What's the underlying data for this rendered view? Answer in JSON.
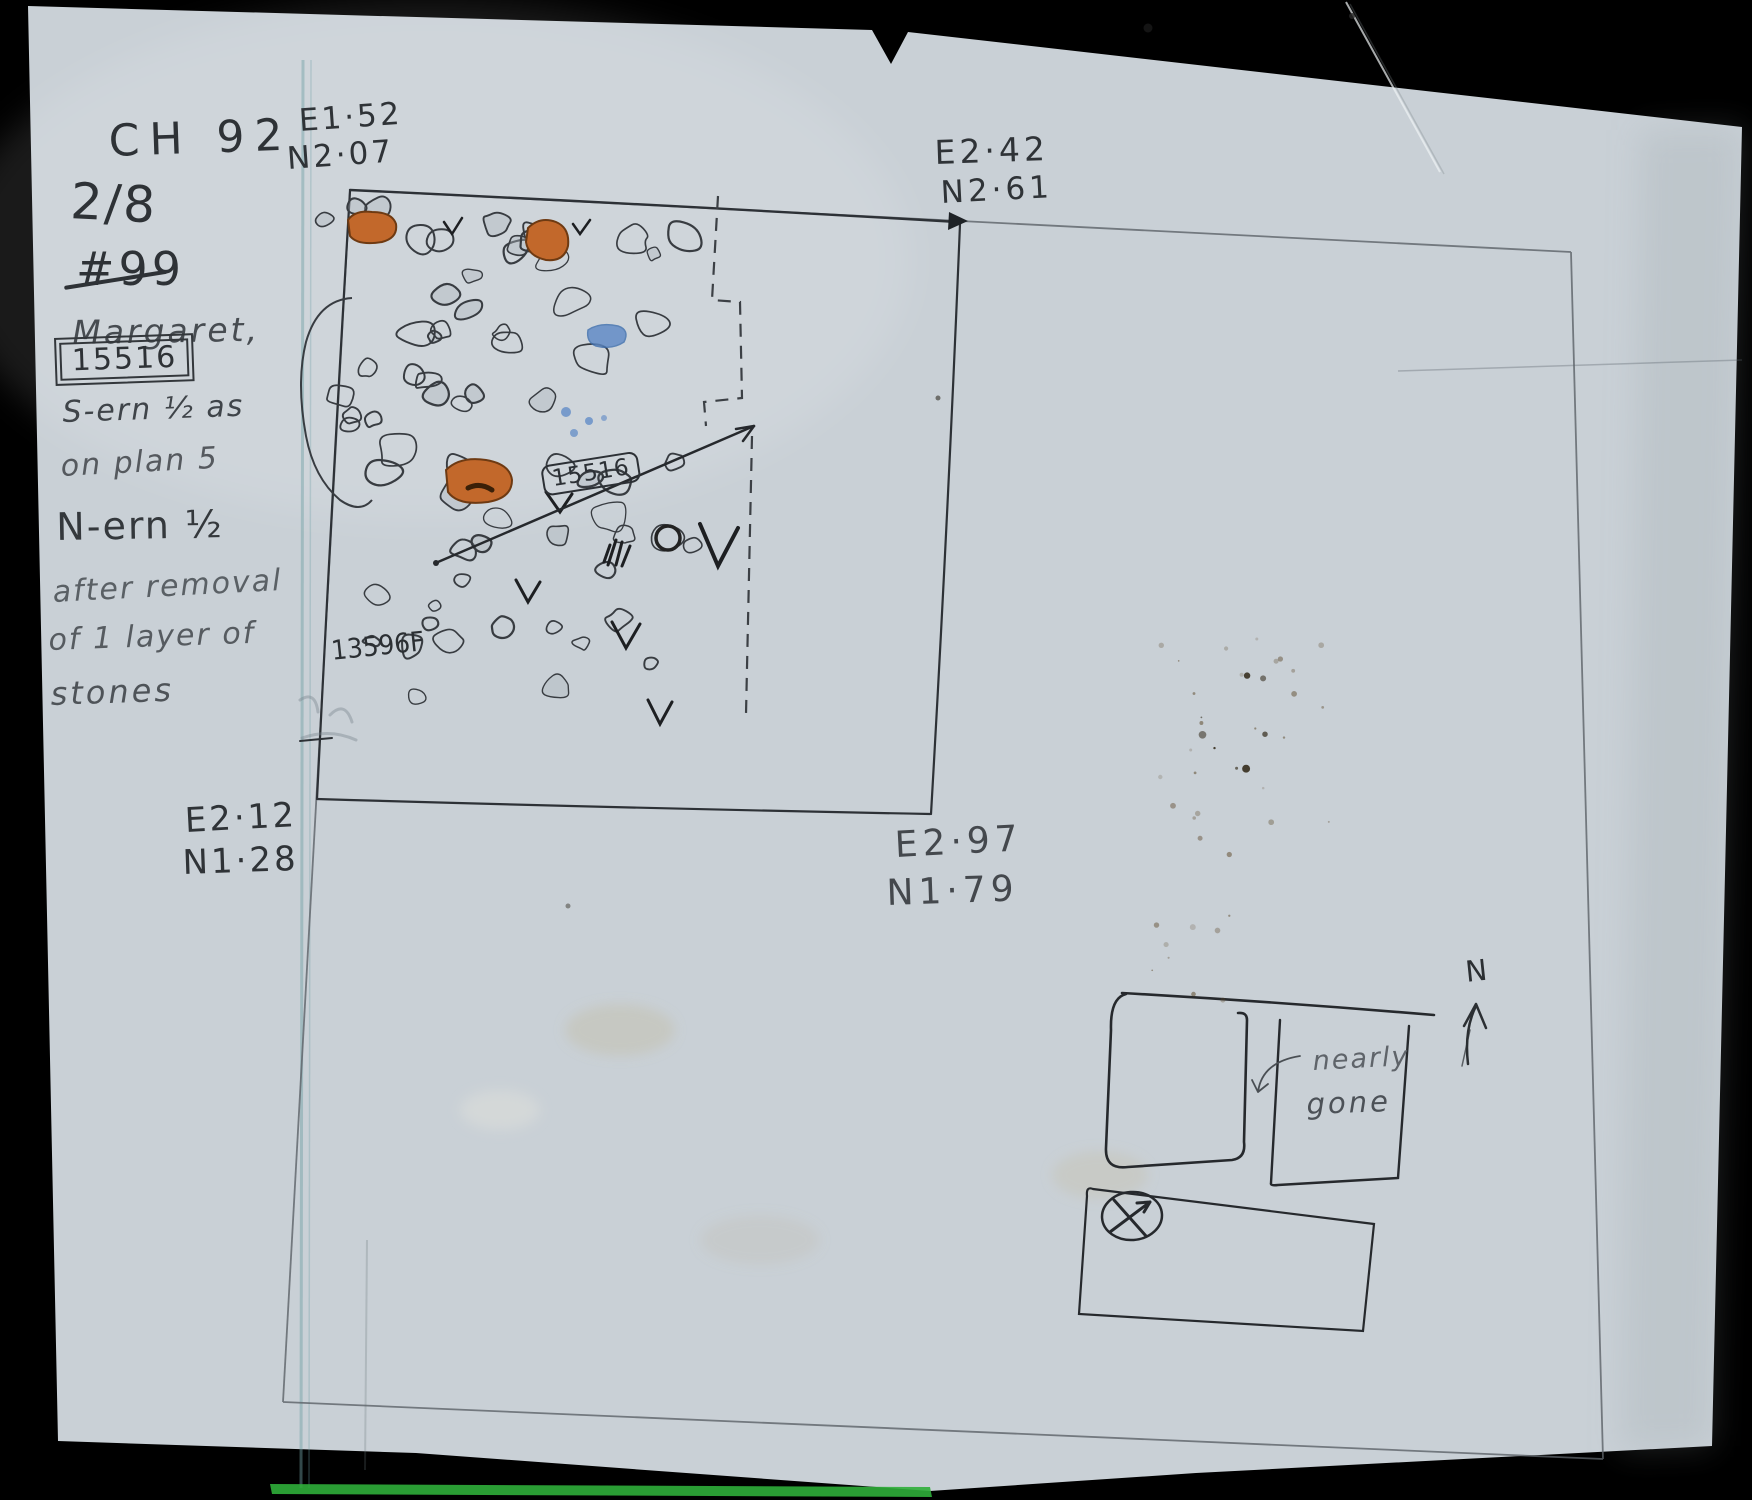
{
  "page": {
    "paper_color": "#c9d0d6",
    "background_color": "#000000",
    "green_strip_color": "#2fae3a"
  },
  "annotations": {
    "site_code": "CH 92",
    "sheet_fraction": "2/8",
    "struck_number": "#99",
    "recorder_name": "Margaret,",
    "boxed_find_number": "15516",
    "note_line1": "S-ern ½ as",
    "note_line2": "on plan 5",
    "note_line3": "N-ern ½",
    "note_line4": "after removal",
    "note_line5": "of 1 layer of",
    "note_line6": "stones"
  },
  "coordinates": {
    "top_left": {
      "e": "E1·52",
      "n": "N2·07"
    },
    "top_right": {
      "e": "E2·42",
      "n": "N2·61"
    },
    "bottom_left": {
      "e": "E2·12",
      "n": "N1·28"
    },
    "bottom_right": {
      "e": "E2·97",
      "n": "N1·79"
    }
  },
  "plan": {
    "find_label": "15516",
    "find_label_secondary": "13596F",
    "colors": {
      "orange_stone": "#c2682b",
      "orange_stone_outline": "#6e3a12",
      "blue_mark": "#5b87c5",
      "pencil_dark": "#2d3136",
      "pencil_light": "#5c6268"
    }
  },
  "inset": {
    "note_line1": "nearly",
    "note_line2": "gone",
    "north_label": "N"
  }
}
